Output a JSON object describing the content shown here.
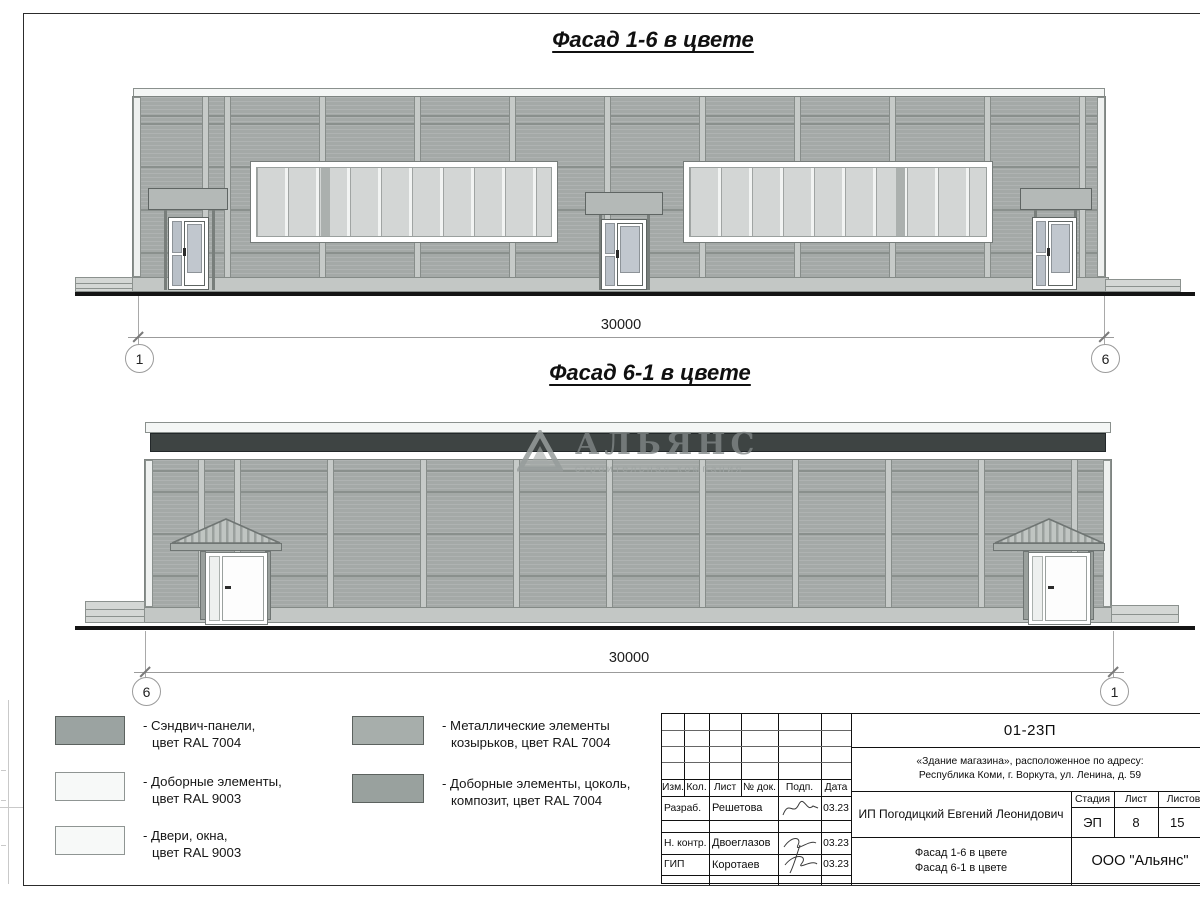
{
  "sheet": {
    "facade1": {
      "title": "Фасад 1-6 в цвете",
      "dim": "30000",
      "axis_left": "1",
      "axis_right": "6"
    },
    "facade2": {
      "title": "Фасад 6-1 в цвете",
      "dim": "30000",
      "axis_left": "6",
      "axis_right": "1"
    },
    "watermark": {
      "name": "АЛЬЯНС",
      "tagline": "строительная компания"
    },
    "legend": {
      "items": [
        {
          "color": "#9ba3a1",
          "line1": "- Сэндвич-панели,",
          "line2": "цвет RAL 7004"
        },
        {
          "color": "#f7f9f8",
          "line1": "- Доборные элементы,",
          "line2": "цвет RAL 9003"
        },
        {
          "color": "#f7f9f8",
          "line1": "- Двери, окна,",
          "line2": "цвет RAL 9003"
        },
        {
          "color": "#a7aeab",
          "line1": "- Металлические элементы",
          "line2": "козырьков, цвет RAL 7004"
        },
        {
          "color": "#99a19e",
          "line1": "- Доборные элементы, цоколь,",
          "line2": "композит, цвет RAL 7004"
        }
      ]
    },
    "stamp": {
      "doc_number": "01-23П",
      "object_line1": "«Здание магазина», расположенное по адресу:",
      "object_line2": "Республика Коми, г. Воркута, ул. Ленина, д. 59",
      "columns": {
        "izm": "Изм.",
        "kol": "Кол.",
        "list": "Лист",
        "doc": "№ док.",
        "podp": "Подп.",
        "data": "Дата"
      },
      "signers": [
        {
          "role": "Разраб.",
          "name": "Решетова",
          "date": "03.23"
        },
        {
          "role": "Н. контр.",
          "name": "Двоеглазов",
          "date": "03.23"
        },
        {
          "role": "ГИП",
          "name": "Коротаев",
          "date": "03.23"
        }
      ],
      "client": "ИП Погодицкий Евгений Леонидович",
      "stage_label": "Стадия",
      "sheet_label": "Лист",
      "sheets_label": "Листов",
      "stage": "ЭП",
      "sheet_num": "8",
      "sheets_total": "15",
      "content_line1": "Фасад 1-6 в цвете",
      "content_line2": "Фасад 6-1 в цвете",
      "company": "ООО \"Альянс\""
    }
  }
}
